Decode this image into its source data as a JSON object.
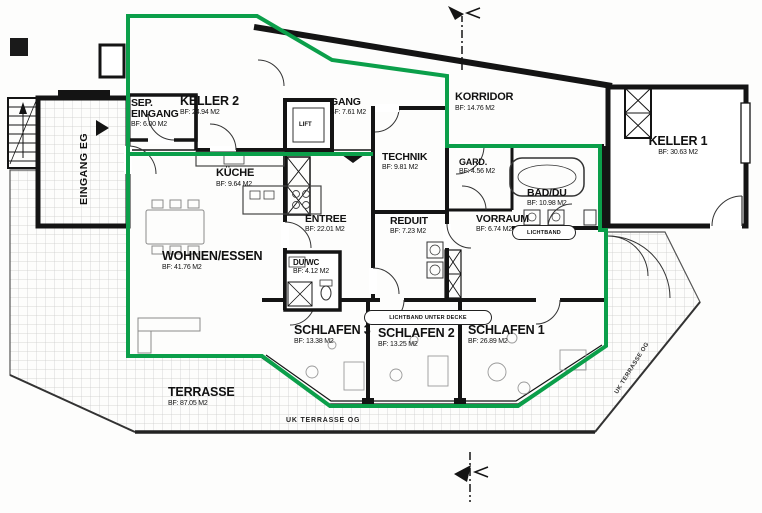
{
  "meta": {
    "drawing_type": "apartment floor plan",
    "palette": {
      "boundary_green": "#0b9f4a",
      "wall_black": "#141414",
      "tile_gray": "#c9c9c9"
    }
  },
  "rooms": [
    {
      "id": "sep-eingang",
      "name": "SEP.\nEINGANG",
      "area": "BF: 6.00 M2"
    },
    {
      "id": "keller-2",
      "name": "KELLER 2",
      "area": "BF: 24.94 M2"
    },
    {
      "id": "gang",
      "name": "GANG",
      "area": "BF: 7.61 M2"
    },
    {
      "id": "korridor",
      "name": "KORRIDOR",
      "area": "BF: 14.76 M2"
    },
    {
      "id": "keller-1",
      "name": "KELLER 1",
      "area": "BF: 30.63 M2"
    },
    {
      "id": "technik",
      "name": "TECHNIK",
      "area": "BF: 9.81 M2"
    },
    {
      "id": "gard",
      "name": "GARD.",
      "area": "BF: 4.56 M2"
    },
    {
      "id": "bad-du",
      "name": "BAD/DU",
      "area": "BF: 10.98 M2"
    },
    {
      "id": "kueche",
      "name": "KÜCHE",
      "area": "BF: 9.64 M2"
    },
    {
      "id": "entree",
      "name": "ENTREE",
      "area": "BF: 22.01 M2"
    },
    {
      "id": "reduit",
      "name": "REDUIT",
      "area": "BF: 7.23 M2"
    },
    {
      "id": "vorraum",
      "name": "VORRAUM",
      "area": "BF: 6.74 M2"
    },
    {
      "id": "wohnen-essen",
      "name": "WOHNEN/ESSEN",
      "area": "BF: 41.76 M2"
    },
    {
      "id": "du-wc",
      "name": "DU/WC",
      "area": "BF: 4.12 M2"
    },
    {
      "id": "schlafen-3",
      "name": "SCHLAFEN 3",
      "area": "BF: 13.38 M2"
    },
    {
      "id": "schlafen-2",
      "name": "SCHLAFEN 2",
      "area": "BF: 13.25 M2"
    },
    {
      "id": "schlafen-1",
      "name": "SCHLAFEN 1",
      "area": "BF: 26.89 M2"
    },
    {
      "id": "terrasse",
      "name": "TERRASSE",
      "area": "BF: 87.05 M2"
    }
  ],
  "annotations": {
    "lift": "LIFT",
    "eingang_eg": "EINGANG  EG",
    "lichtband": "LICHTBAND",
    "lichtband_unter_decke": "LICHTBAND UNTER DECKE",
    "uk_terrasse_og": "UK TERRASSE OG"
  }
}
